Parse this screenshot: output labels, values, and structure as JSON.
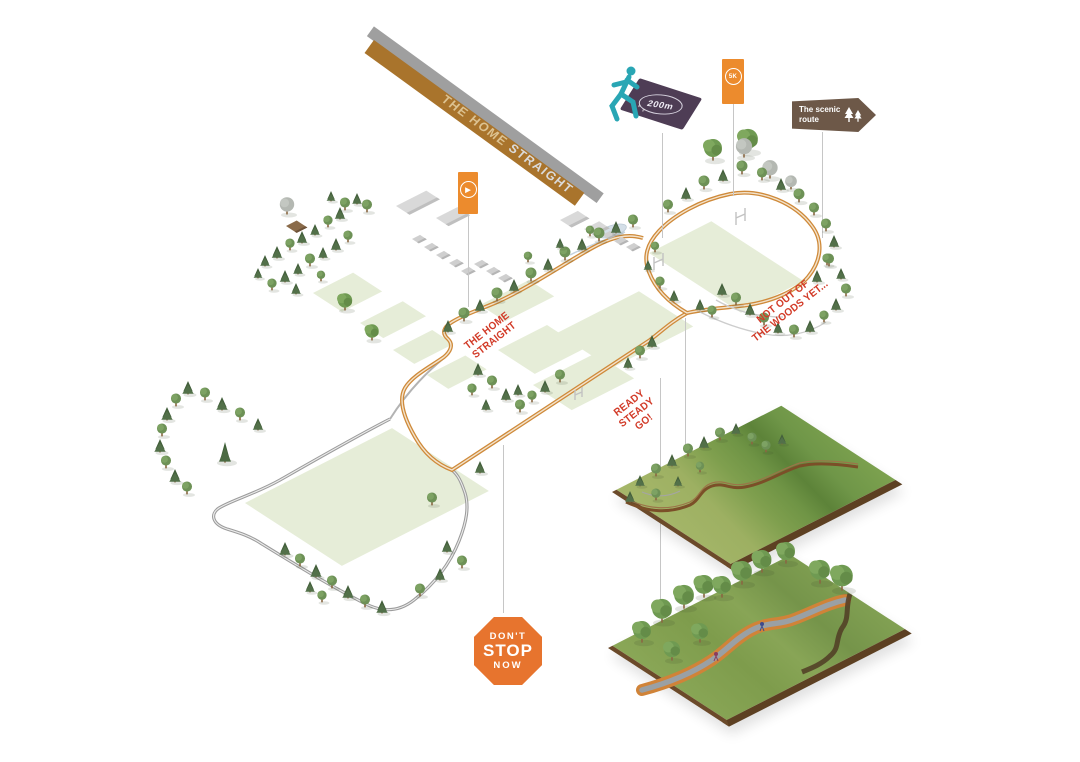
{
  "banner": {
    "part1": "THE HOME",
    "part2": "STRAIGHT"
  },
  "signs": {
    "distance_marker": {
      "value": "200m"
    },
    "route_badge": {
      "value": "5K"
    },
    "media_marker": {
      "glyph": "▶"
    },
    "scenic": {
      "label": "The scenic route"
    },
    "stop": {
      "line1": "DON'T",
      "line2": "STOP",
      "line3": "NOW"
    }
  },
  "annotations": {
    "home_straight": {
      "line1": "THE HOME",
      "line2": "STRAIGHT"
    },
    "woods": {
      "line1": "NOT OUT OF",
      "line2": "THE WOODS YET..."
    },
    "ready_steady": {
      "line1": "READY",
      "line2": "STEADY",
      "line3": "GO!"
    }
  },
  "colors": {
    "route_orange": "#cf8a3a",
    "existing_path_gray": "#9c9c9c",
    "annotation_red": "#d23b28",
    "marker_orange": "#ec8b2d",
    "marker_purple": "#4e3d55",
    "sign_brown": "#6d5848",
    "runner_teal": "#29a6b4",
    "field_green": "#e6edd8",
    "ribbon_brown": "#a9742c",
    "stop_orange": "#e7742e"
  }
}
